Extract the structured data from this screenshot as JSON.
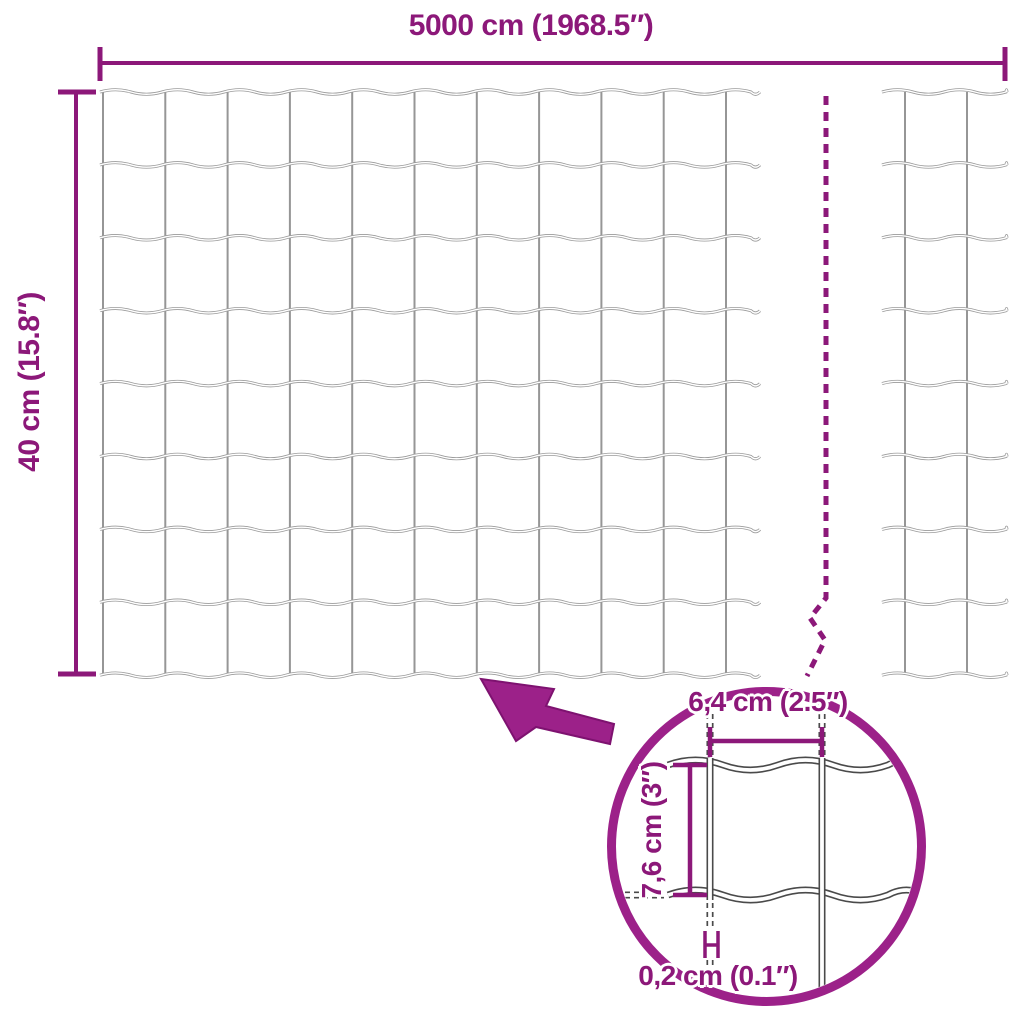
{
  "diagram": {
    "type": "product-dimension-diagram",
    "subject": "welded wire mesh fence roll with wavy horizontal wires",
    "background_color": "#ffffff"
  },
  "main_dimensions": {
    "width_label": "5000 cm (1968.5″)",
    "height_label": "40 cm (15.8″)"
  },
  "detail": {
    "mesh_width_label": "6,4 cm (2.5″)",
    "mesh_height_label": "7,6 cm (3″)",
    "wire_thickness_label": "0,2 cm (0.1″)"
  },
  "icons": {
    "pointer_arrow": "filled arrow pointing from detail circle to mesh",
    "break_line": "dashed vertical break line with zigzag"
  },
  "colors": {
    "accent": "#8C1879",
    "accent_bright": "#9C2189",
    "mesh_wire_gray": "#9A9A9A",
    "detail_wire_outline": "#4A4A4A"
  }
}
